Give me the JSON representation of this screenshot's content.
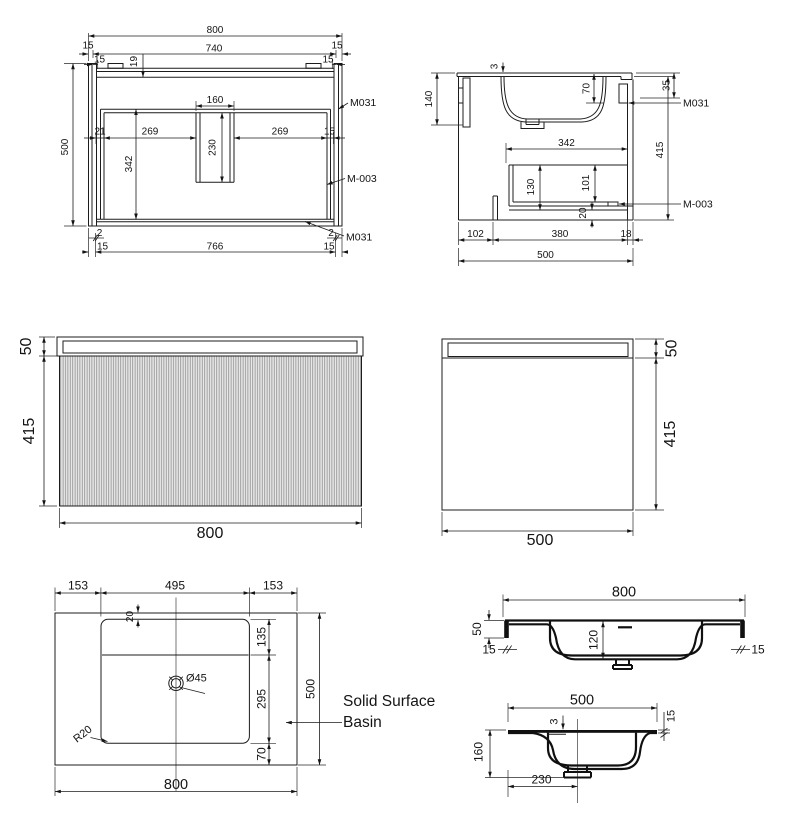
{
  "colors": {
    "line": "#1c1c1c",
    "flute_fill": "#e9e9e9",
    "flute_stripe": "#8c8c8c",
    "background": "#ffffff"
  },
  "front_section": {
    "overall_width": "800",
    "top_panel_width": "740",
    "edge_left": "15",
    "edge_right": "15",
    "inset_left": "15",
    "inset_right": "15",
    "rail_height": "19",
    "overall_height": "500",
    "divider_width": "160",
    "offset_left": "21",
    "bay_left": "269",
    "divider_height": "230",
    "bay_right": "269",
    "gap_right": "15",
    "inner_height": "342",
    "foot_left": "2",
    "foot_right": "2",
    "base_width": "766",
    "base_left": "15",
    "base_right": "15",
    "part_top": "M031",
    "part_mid": "M-003",
    "part_bottom": "M031"
  },
  "side_section": {
    "basin_height": "140",
    "top_thickness": "3",
    "bowl_depth": "70",
    "hanger_offset": "35",
    "part_hanger": "M031",
    "drawer_width": "342",
    "drawer_height": "130",
    "drawer_inner": "101",
    "base_gap": "20",
    "part_runner": "M-003",
    "back_depth": "102",
    "drawer_depth": "380",
    "front_gap": "18",
    "overall_depth": "500",
    "cabinet_height": "415"
  },
  "front_elevation": {
    "top_height": "50",
    "body_height": "415",
    "width": "800"
  },
  "side_elevation": {
    "top_height": "50",
    "body_height": "415",
    "depth": "500"
  },
  "basin_top": {
    "margin_left": "153",
    "bowl_width": "495",
    "margin_right": "153",
    "rim_offset": "20",
    "ledge_depth": "135",
    "bowl_depth": "295",
    "front_margin": "70",
    "overall_depth": "500",
    "overall_width": "800",
    "drain_diameter": "Ø45",
    "corner_radius": "R20",
    "note_line1": "Solid Surface",
    "note_line2": "Basin"
  },
  "basin_section_length": {
    "width": "800",
    "edge_height": "50",
    "edge_left": "15",
    "bowl_depth": "120",
    "edge_right": "15"
  },
  "basin_section_width": {
    "depth": "500",
    "ledge_drop": "3",
    "rim_thickness": "15",
    "total_height": "160",
    "drain_offset": "230"
  }
}
